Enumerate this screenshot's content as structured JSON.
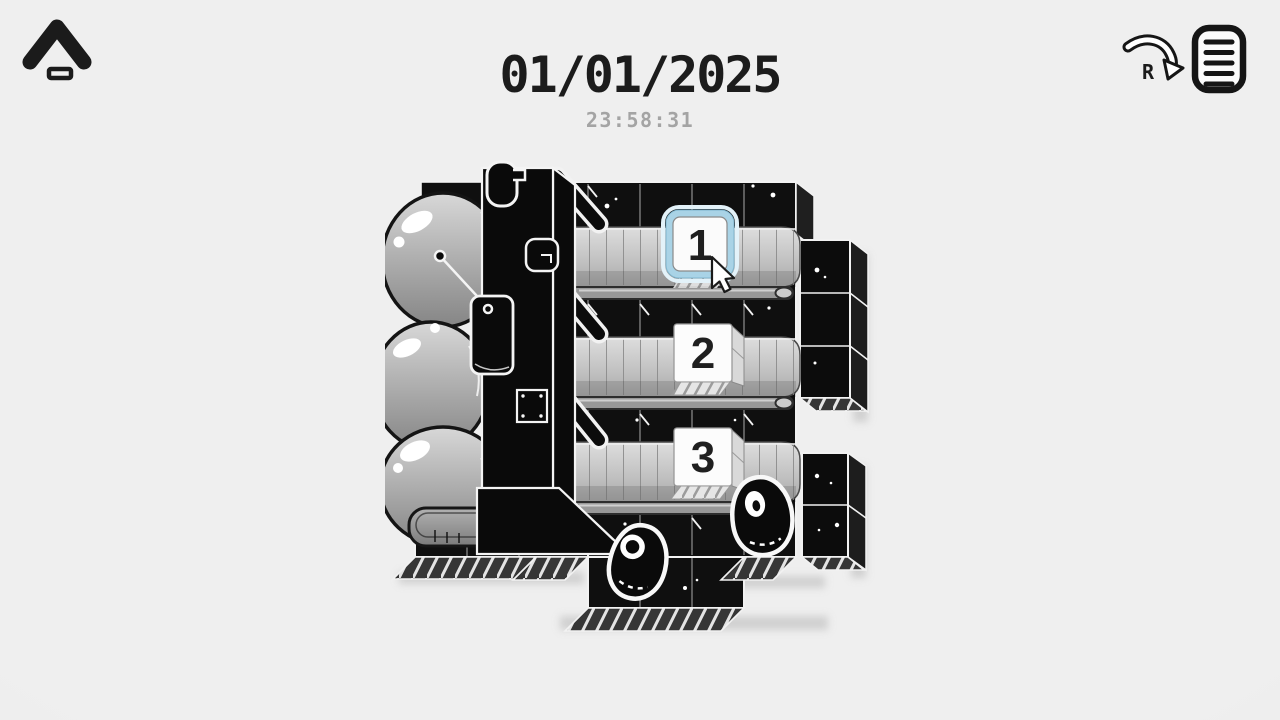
{
  "hud": {
    "back_button": {
      "icon": "chevron-up-icon"
    },
    "date": "01/01/2025",
    "time": "23:58:31",
    "journal": {
      "shortcut_key": "R",
      "icon": "journal-list-icon",
      "arrow_icon": "curved-arrow-icon"
    }
  },
  "scene": {
    "kind": "monochrome-conveyor-puzzle",
    "conveyors": [
      {
        "number": "1",
        "selected": true
      },
      {
        "number": "2",
        "selected": false
      },
      {
        "number": "3",
        "selected": false
      }
    ],
    "colors": {
      "background": "#ececec",
      "ink": "#0f0f0f",
      "outline_white": "#f2f2f2",
      "belt_gray": "#c4c4c4",
      "blob_gray": "#a9a9a9",
      "selection_blue": "#a9d3e6",
      "time_text": "#a4a4a4"
    }
  }
}
